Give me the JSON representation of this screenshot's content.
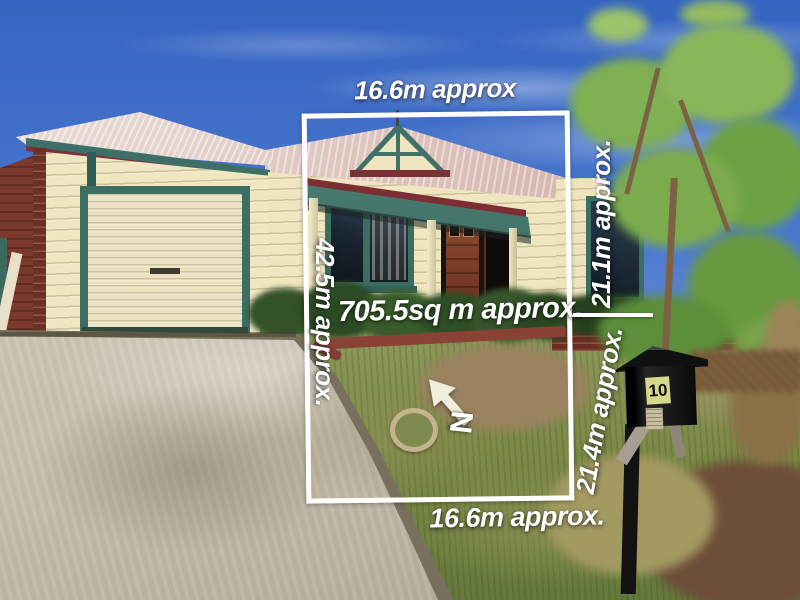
{
  "overlay": {
    "top_width_label": "16.6m approx",
    "left_depth_label": "42.5m approx.",
    "area_label": "705.5sq m approx.",
    "right_depth_upper_label": "21.1m approx.",
    "right_depth_lower_label": "21.4m approx.",
    "bottom_width_label": "16.6m approx.",
    "north_label": "N"
  },
  "scene": {
    "house_number": "10"
  },
  "colors": {
    "annotation_white": "#ffffff",
    "sky_blue": "#4a77cd",
    "wall_cream": "#f0e7c2",
    "trim_teal": "#3c6e64",
    "fascia_maroon": "#7d3038",
    "brick_red": "#7b382c",
    "door_redbrown": "#7d3b26",
    "roof_silver_pink": "#ddc4bd",
    "foliage_green": "#7cab4e",
    "driveway_concrete": "#c6bdab",
    "letterbox_black": "#141414",
    "letterbox_label_yellow": "#d6d88c"
  }
}
